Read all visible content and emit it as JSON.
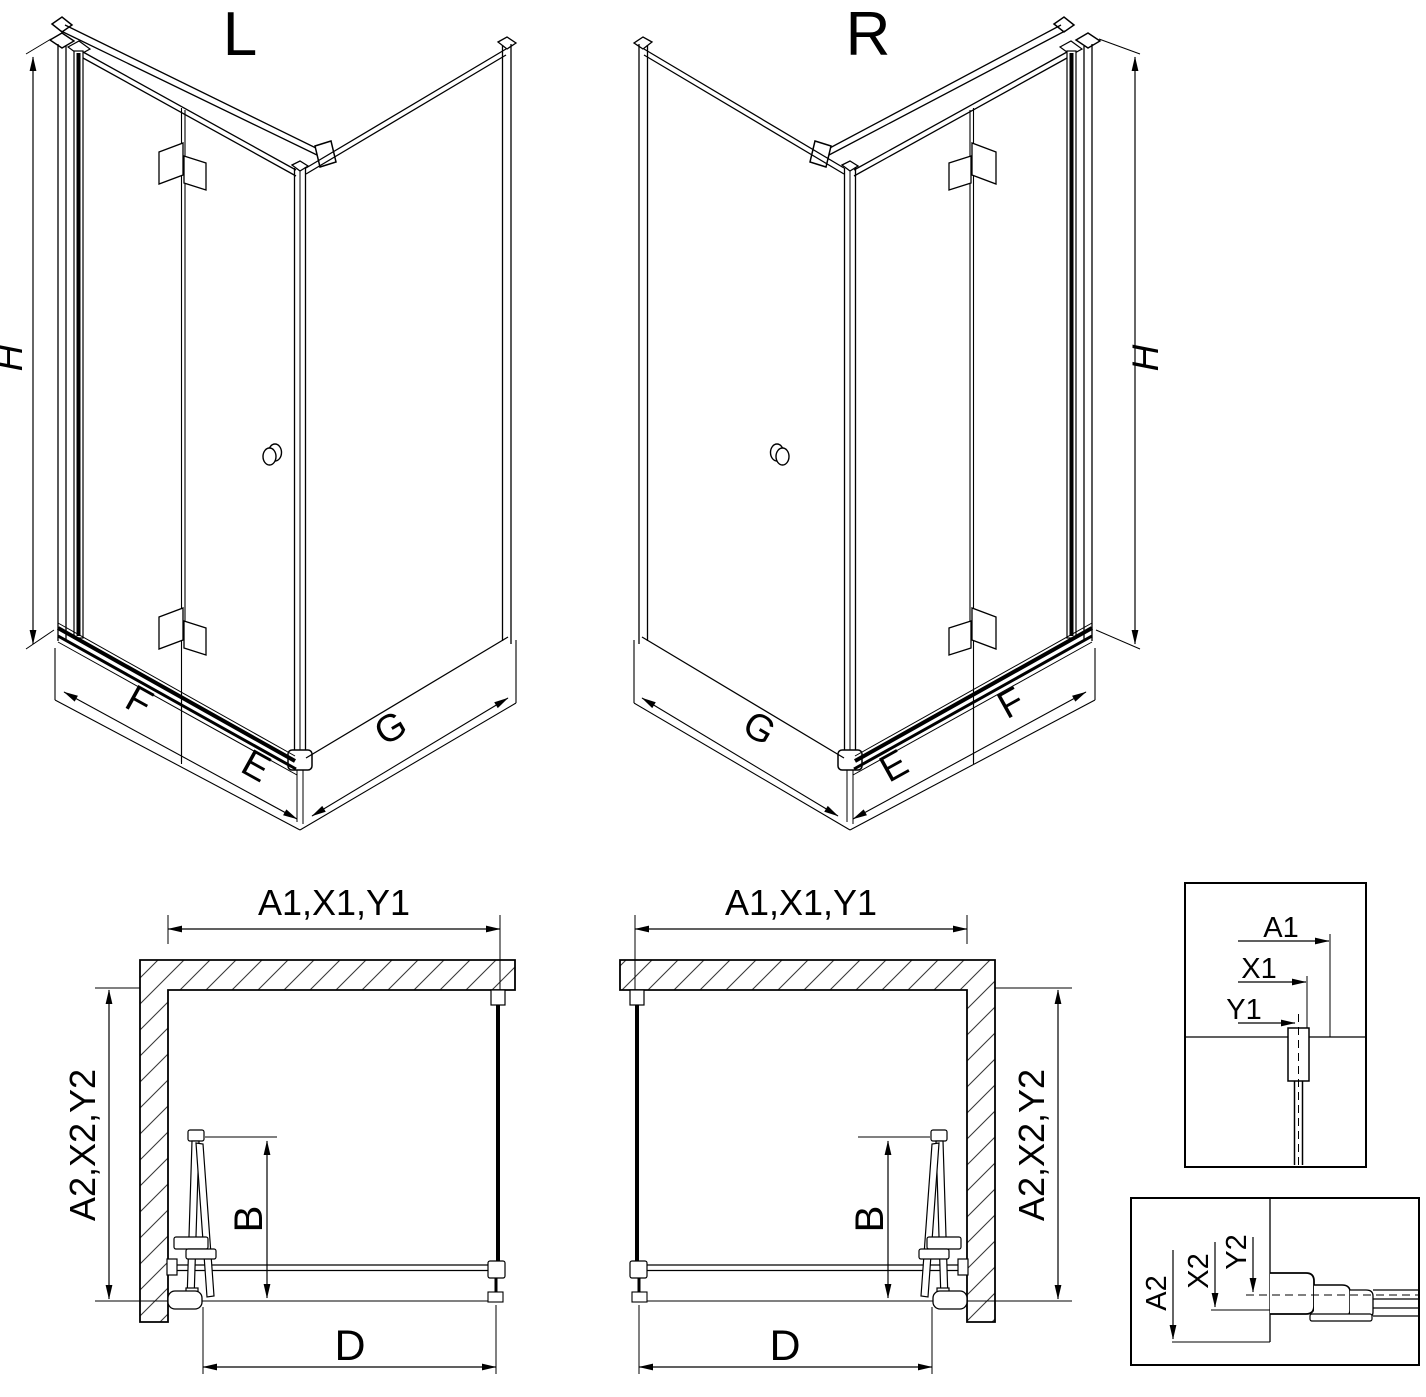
{
  "drawing_title": "Corner shower enclosure with bi-fold door - dimension diagram",
  "iso_views": {
    "left": {
      "variant_label": "L",
      "height_dim": "H",
      "door_width_dim": "F",
      "fixed_width_dim": "E",
      "side_width_dim": "G"
    },
    "right": {
      "variant_label": "R",
      "height_dim": "H",
      "door_width_dim": "F",
      "fixed_width_dim": "E",
      "side_width_dim": "G"
    }
  },
  "plan_views": {
    "left": {
      "top_width_dim": "A1,X1,Y1",
      "side_depth_dim": "A2,X2,Y2",
      "door_projection_dim": "B",
      "entry_width_dim": "D"
    },
    "right": {
      "top_width_dim": "A1,X1,Y1",
      "side_depth_dim": "A2,X2,Y2",
      "door_projection_dim": "B",
      "entry_width_dim": "D"
    }
  },
  "details": {
    "top_box": {
      "dim_labels": [
        "A1",
        "X1",
        "Y1"
      ]
    },
    "bottom_box": {
      "dim_labels": [
        "A2",
        "X2",
        "Y2"
      ]
    }
  },
  "colors": {
    "line": "#000000",
    "background": "#ffffff",
    "hatch": "#3a3a3a"
  }
}
